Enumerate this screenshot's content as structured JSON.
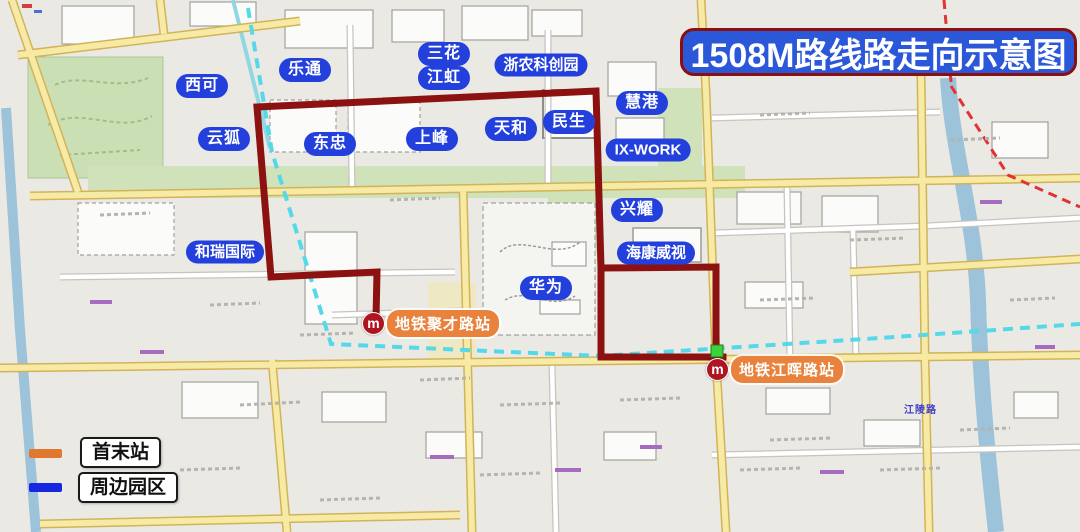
{
  "title": "1508M路线路走向示意图",
  "legend": [
    {
      "label": "首末站",
      "color": "#e0782f"
    },
    {
      "label": "周边园区",
      "color": "#1726e0"
    }
  ],
  "map": {
    "area_labels": [
      "西可",
      "乐通",
      "三花",
      "江虹",
      "云狐",
      "东忠",
      "上峰",
      "天和",
      "民生",
      "浙农科创园",
      "慧港",
      "IX-WORK",
      "兴耀",
      "海康威视",
      "华为",
      "和瑞国际"
    ],
    "stations": [
      {
        "name": "地铁聚才路站"
      },
      {
        "name": "地铁江晖路站"
      }
    ],
    "metro_glyph": "m",
    "road_labels": [
      {
        "text": "江陵路"
      }
    ],
    "colors": {
      "route": "#8c1111",
      "title_bg": "#2b57d9",
      "title_border": "#8a1010",
      "area_label_bg": "#2340dd",
      "station_bg": "#e8823c",
      "metro_logo_bg": "#ae1520",
      "metro_line": "#55d8ea",
      "terminal_dot": "#3bd43b",
      "major_road": "#f7eaa4",
      "park_green": "#cbdfb5",
      "river": "#9cc3da"
    }
  }
}
